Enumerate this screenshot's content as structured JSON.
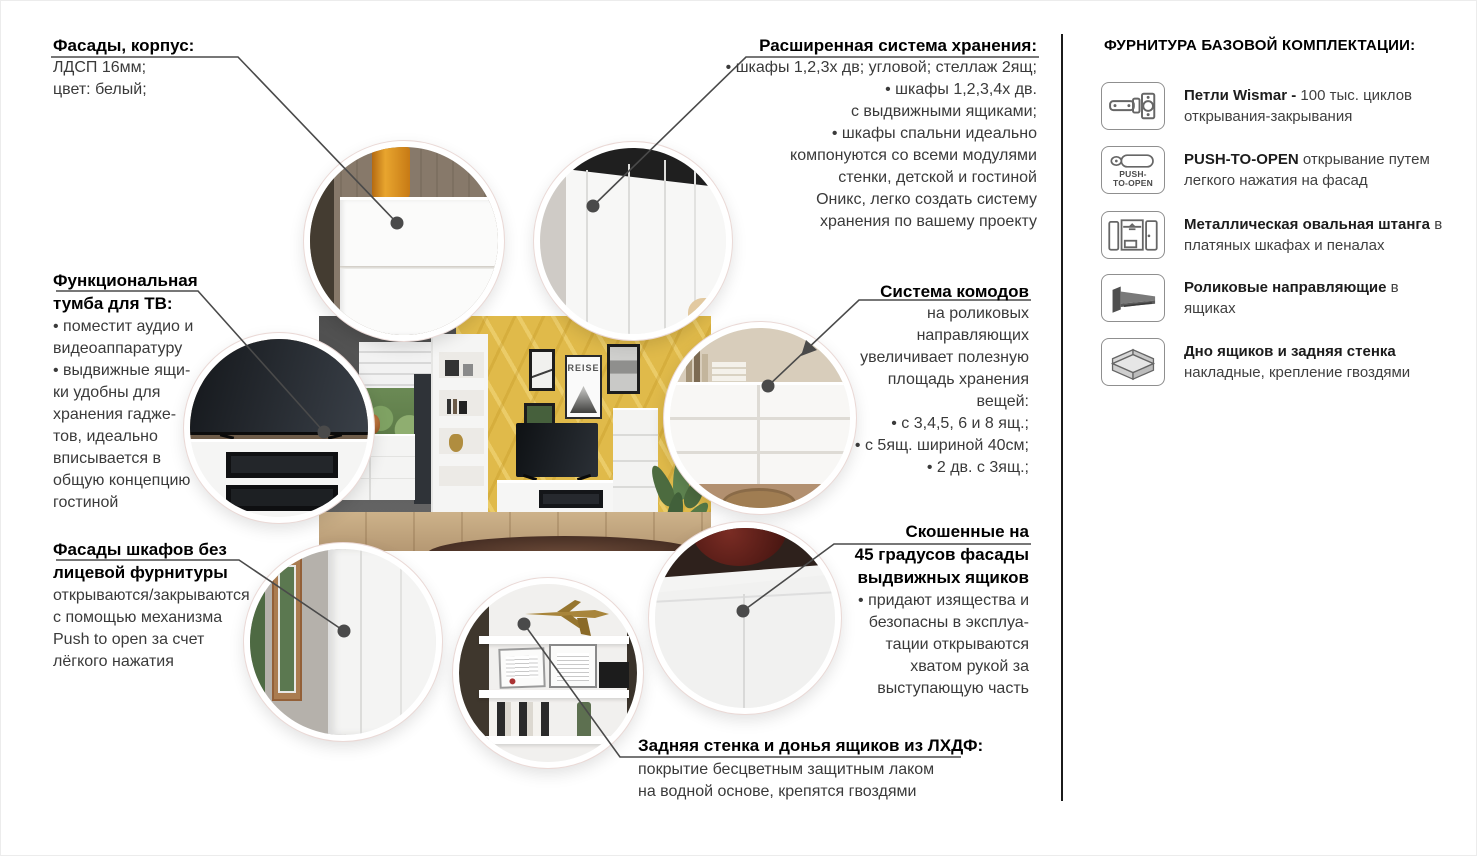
{
  "colors": {
    "line": "#4a4a4a",
    "text": "#3a3a3a",
    "title": "#000000",
    "yellow_wall": "#e0ba4a",
    "divider": "#1b1b1b",
    "bubble_ring": "#ffffff"
  },
  "callouts": {
    "facades_body": {
      "title": "Фасады, корпус:",
      "lines": [
        "ЛДСП 16мм;",
        "цвет: белый;"
      ]
    },
    "storage_system": {
      "title": "Расширенная система хранения:",
      "lines": [
        "• шкафы 1,2,3х дв; угловой; стеллаж 2ящ;",
        "• шкафы 1,2,3,4х дв.",
        "с выдвижными ящиками;",
        "• шкафы спальни идеально",
        "компонуются со всеми модулями",
        "стенки, детской и гостиной",
        "Оникс, легко создать систему",
        "хранения по вашему проекту"
      ]
    },
    "tv_stand": {
      "title_line1": "Функциональная",
      "title_line2": "тумба для ТВ:",
      "lines": [
        "• поместит аудио и",
        "видеоаппаратуру",
        "• выдвижные ящи-",
        "ки удобны для",
        "хранения гадже-",
        "тов, идеально",
        "вписывается в",
        "общую концепцию",
        "гостиной"
      ]
    },
    "drawers_system": {
      "title": "Система комодов",
      "lines": [
        "на роликовых",
        "направляющих",
        "увеличивает полезную",
        "площадь хранения",
        "вещей:",
        "• с 3,4,5, 6 и 8 ящ.;",
        "• с 5ящ. шириной 40см;",
        "• 2 дв. с 3ящ.;"
      ]
    },
    "push_facades": {
      "title_line1": "Фасады шкафов без",
      "title_line2": "лицевой фурнитуры",
      "lines": [
        "открываются/закрываются",
        "с помощью механизма",
        "Push to open за счет",
        "лёгкого нажатия"
      ]
    },
    "angled_facades": {
      "title_line1": "Скошенные на",
      "title_line2": "45 градусов фасады",
      "title_line3": "выдвижных ящиков",
      "lines": [
        "• придают изящества и",
        "безопасны в эксплуа-",
        "тации открываются",
        "хватом рукой за",
        "выступающую часть"
      ]
    },
    "back_panel": {
      "title": "Задняя стенка и донья ящиков из ЛХДФ:",
      "lines": [
        "покрытие бесцветным защитным лаком",
        "на водной основе, крепятся гвоздями"
      ]
    }
  },
  "hardware_panel": {
    "title": "ФУРНИТУРА БАЗОВОЙ КОМПЛЕКТАЦИИ:",
    "items": [
      {
        "icon": "hinge-icon",
        "bold": "Петли Wismar -",
        "rest": "100 тыс. циклов открывания-закрывания"
      },
      {
        "icon": "push-to-open-icon",
        "icon_label_1": "PUSH-",
        "icon_label_2": "TO-OPEN",
        "bold": "PUSH-TO-OPEN",
        "rest": "открывание путем легкого нажатия на фасад"
      },
      {
        "icon": "wardrobe-rod-icon",
        "bold": "Металлическая овальная штанга",
        "rest": "в платяных шкафах и пеналах"
      },
      {
        "icon": "roller-slide-icon",
        "bold": "Роликовые направляющие",
        "rest": "в ящиках"
      },
      {
        "icon": "drawer-bottom-icon",
        "bold": "Дно ящиков и задняя стенка",
        "rest": "накладные, крепление гвоздями"
      }
    ]
  },
  "scene": {
    "poster_text": "REISE"
  }
}
